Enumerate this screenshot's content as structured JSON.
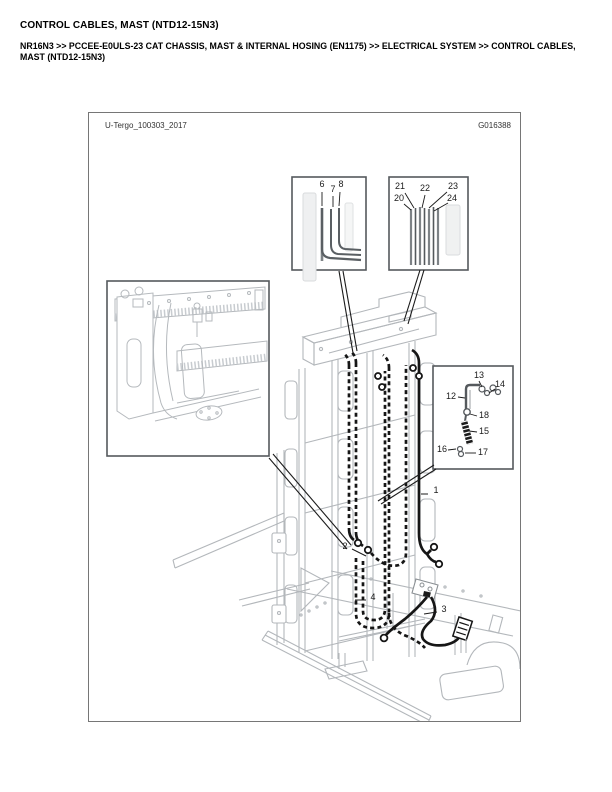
{
  "page": {
    "title": "CONTROL CABLES, MAST (NTD12-15N3)",
    "breadcrumb": "NR16N3 >> PCCEE-E0ULS-23 CAT CHASSIS, MAST & INTERNAL HOSING (EN1175) >> ELECTRICAL SYSTEM >> CONTROL CABLES, MAST (NTD12-15N3)"
  },
  "figure": {
    "drawing_ref": "U-Tergo_100303_2017",
    "figure_code": "G016388",
    "callouts": {
      "1": "1",
      "2": "2",
      "3": "3",
      "4": "4",
      "6": "6",
      "7": "7",
      "8": "8",
      "12": "12",
      "13": "13",
      "14": "14",
      "15": "15",
      "16": "16",
      "17": "17",
      "18": "18",
      "20": "20",
      "21": "21",
      "22": "22",
      "23": "23",
      "24": "24"
    },
    "colors": {
      "cable_black": "#161616",
      "machine_line_gray": "#b3b7bb",
      "inset_border_gray": "#55595d",
      "figure_border_gray": "#767676"
    }
  }
}
